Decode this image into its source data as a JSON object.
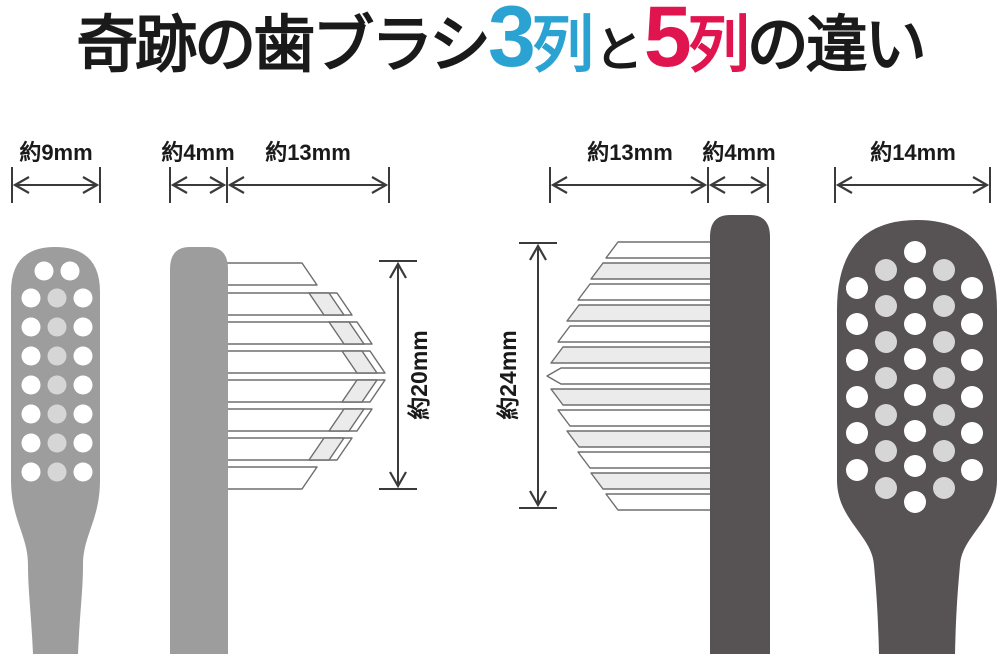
{
  "title": {
    "prefix": "奇跡の歯ブラシ",
    "three_num": "3",
    "three_unit": "列",
    "connector": "と",
    "five_num": "5",
    "five_unit": "列",
    "suffix": "の違い"
  },
  "colors": {
    "accent_blue": "#2ba3d2",
    "accent_red": "#e0154f",
    "title_text": "#1a1a1a",
    "dimension_line": "#3a3a3a",
    "brush_light_gray": "#9d9d9d",
    "brush_dark_gray": "#575254",
    "dot_white": "#ffffff",
    "dot_light_gray": "#d6d6d6",
    "bristle_fill": "#ffffff",
    "bristle_tip_gray": "#ebebeb",
    "bristle_outline": "#6e6e6e"
  },
  "brush3": {
    "head_width_label": "約9mm",
    "neck_width_label": "約4mm",
    "bristle_length_label": "約13mm",
    "bristle_height_label": "約20mm"
  },
  "brush5": {
    "bristle_length_label": "約13mm",
    "neck_width_label": "約4mm",
    "head_width_label": "約14mm",
    "bristle_height_label": "約24mm"
  }
}
